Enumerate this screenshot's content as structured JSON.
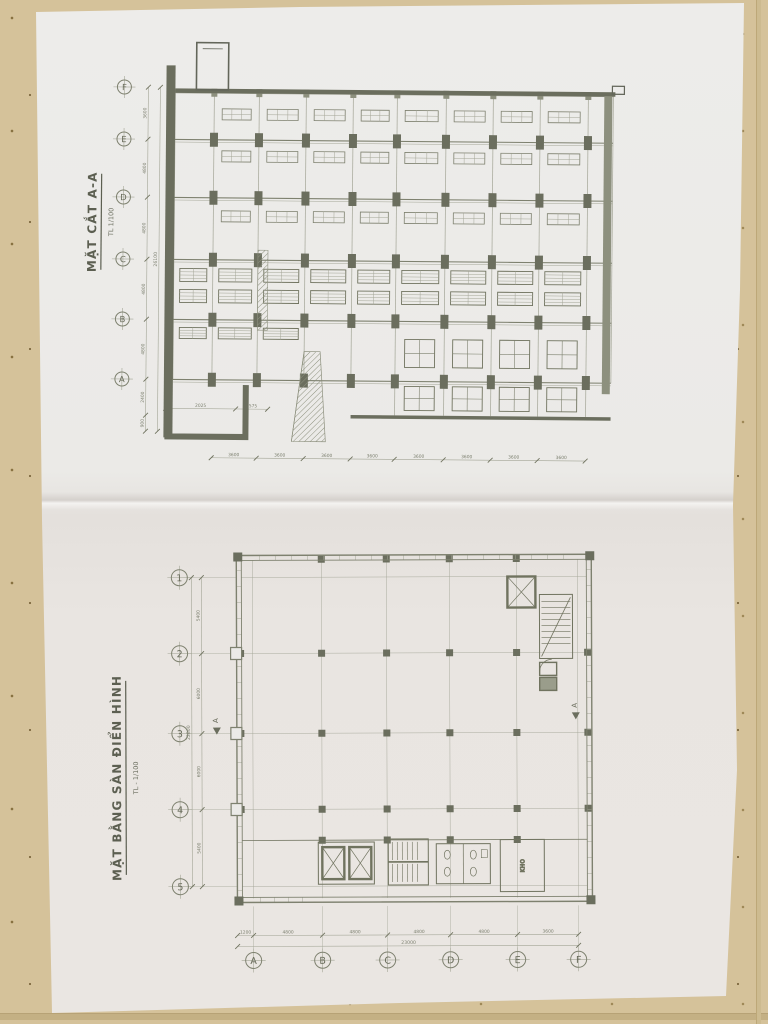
{
  "photo": {
    "surface": "speckled-beige-floor-tiles",
    "media": "folded-white-blueprint-sheet",
    "colors": {
      "tile": "#d5c29a",
      "paper": "#ebeae7",
      "ink_dark": "#62655a",
      "ink_medium": "#868977",
      "ink_light": "#a3a596",
      "dim_text": "#7d8070",
      "shadow": "rgba(90,68,36,0.55)"
    }
  },
  "section": {
    "title": "MẶT CẮT A-A",
    "scale": "TL 1/100",
    "grid_labels": [
      "F",
      "E",
      "D",
      "C",
      "B",
      "A"
    ],
    "left_dims": [
      "3600",
      "4800",
      "4800",
      "4800",
      "4800",
      "2400",
      "900"
    ],
    "left_total": "26100",
    "bottom_dims": [
      "3600",
      "3600",
      "3600",
      "3600",
      "3600",
      "3600",
      "3600",
      "3600"
    ],
    "stair_dims": [
      "2025",
      "1575"
    ]
  },
  "plan": {
    "title": "MẶT BẰNG SÀN ĐIỂN HÌNH",
    "scale": "TL - 1/100",
    "row_labels": [
      "1",
      "2",
      "3",
      "4",
      "5"
    ],
    "col_labels": [
      "A",
      "B",
      "C",
      "D",
      "E",
      "F"
    ],
    "left_dims": [
      "5400",
      "6000",
      "6000",
      "5400"
    ],
    "left_total": "22800",
    "bottom_dims": [
      "1200",
      "4800",
      "4800",
      "4800",
      "4800",
      "3600"
    ],
    "bottom_total": "23000",
    "room_label": "KHO",
    "section_marker": "A"
  }
}
